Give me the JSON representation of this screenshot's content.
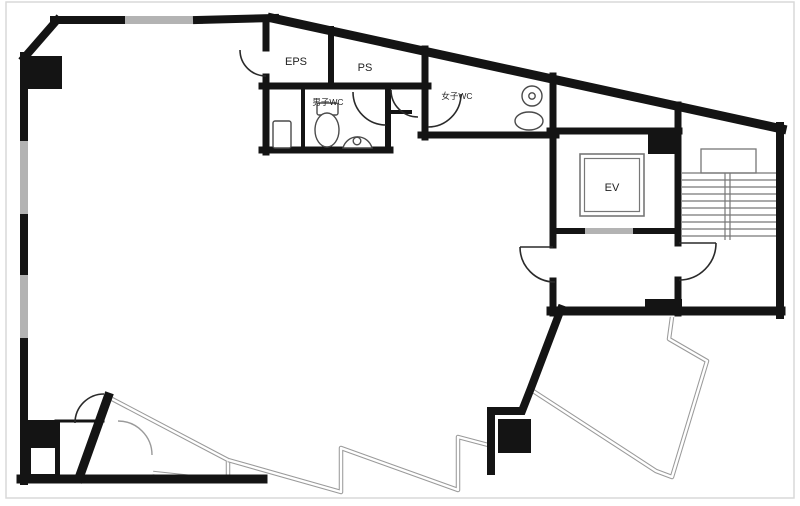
{
  "drawing": {
    "kind": "building-floor-plan",
    "rooms": {
      "eps": {
        "label": "EPS"
      },
      "ps": {
        "label": "PS"
      },
      "mens_wc": {
        "label": "男子WC"
      },
      "womens_wc": {
        "label": "女子WC"
      },
      "elevator": {
        "label": "EV"
      }
    }
  },
  "colors": {
    "wall": "#141414",
    "window": "#b3b3b3",
    "thin_line": "#777777",
    "frame": "#d9d9d9",
    "background": "#ffffff"
  }
}
